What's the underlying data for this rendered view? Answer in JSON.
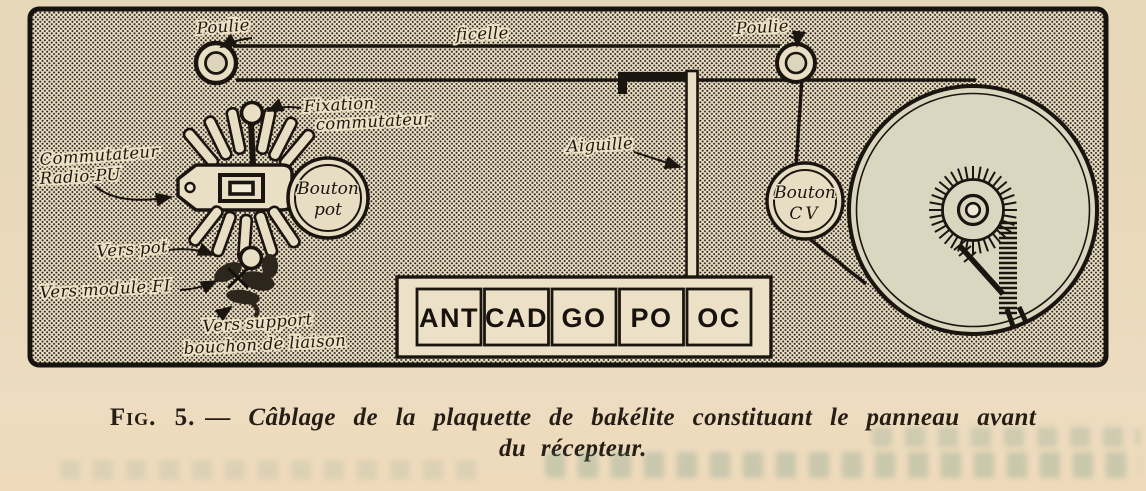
{
  "figure": {
    "labels": {
      "poulie_left": "Poulie",
      "ficelle": "ficelle",
      "poulie_right": "Poulie",
      "fixation_line1": "Fixation",
      "fixation_line2": "commutateur",
      "commutateur_line1": "Commutateur",
      "commutateur_line2": "Radio-PU",
      "aiguille": "Aiguille",
      "bouton_pot_line1": "Bouton",
      "bouton_pot_line2": "pot",
      "bouton_cv_line1": "Bouton",
      "bouton_cv_line2": "CV",
      "vers_pot": "Vers pot",
      "vers_module_fi": "Vers module FI",
      "vers_support_line1": "Vers support",
      "vers_support_line2": "bouchon de liaison"
    },
    "band_strip": {
      "cells": [
        "ANT",
        "CAD",
        "GO",
        "PO",
        "OC"
      ]
    }
  },
  "caption": {
    "fig_label": "Fig. 5.",
    "text": "— Câblage de la plaquette de bakélite constituant le panneau avant",
    "line2": "du récepteur."
  },
  "colors": {
    "paper": "#ead9bb",
    "halftone_base": "#ede2c7",
    "halftone_dot": "#262019",
    "ink": "#1b1510",
    "cream_highlight": "#e9dfc5",
    "dial_fill": "#dbd6c0",
    "caption_ink": "#261e15",
    "bleed_teal": "#588c7c"
  }
}
